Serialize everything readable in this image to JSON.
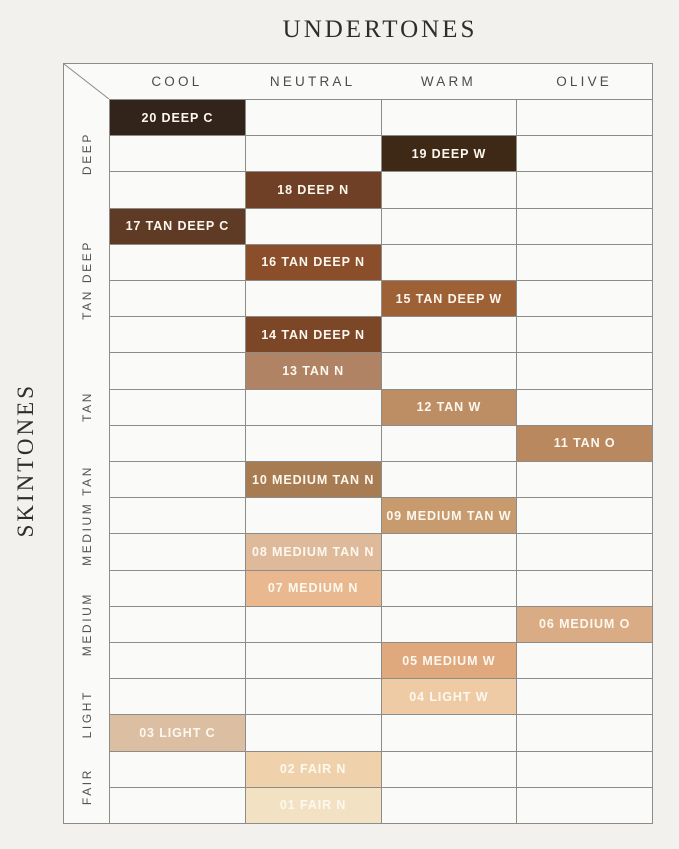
{
  "chart_data": {
    "type": "table",
    "title": "UNDERTONES",
    "ylabel": "SKINTONES",
    "columns": [
      "COOL",
      "NEUTRAL",
      "WARM",
      "OLIVE"
    ],
    "row_groups": [
      {
        "label": "DEEP",
        "rows": 3
      },
      {
        "label": "TAN DEEP",
        "rows": 4
      },
      {
        "label": "TAN",
        "rows": 3
      },
      {
        "label": "MEDIUM TAN",
        "rows": 3
      },
      {
        "label": "MEDIUM",
        "rows": 3
      },
      {
        "label": "LIGHT",
        "rows": 2
      },
      {
        "label": "FAIR",
        "rows": 2
      }
    ],
    "cells": [
      {
        "row": 1,
        "col": 1,
        "label": "20 DEEP C",
        "group": "DEEP",
        "undertone": "COOL",
        "color": "#32241b"
      },
      {
        "row": 2,
        "col": 3,
        "label": "19 DEEP W",
        "group": "DEEP",
        "undertone": "WARM",
        "color": "#3e2917"
      },
      {
        "row": 3,
        "col": 2,
        "label": "18 DEEP N",
        "group": "DEEP",
        "undertone": "NEUTRAL",
        "color": "#6f4026"
      },
      {
        "row": 4,
        "col": 1,
        "label": "17 TAN DEEP C",
        "group": "TAN DEEP",
        "undertone": "COOL",
        "color": "#5f3b25"
      },
      {
        "row": 5,
        "col": 2,
        "label": "16 TAN DEEP N",
        "group": "TAN DEEP",
        "undertone": "NEUTRAL",
        "color": "#8a4e2a"
      },
      {
        "row": 6,
        "col": 3,
        "label": "15 TAN DEEP W",
        "group": "TAN DEEP",
        "undertone": "WARM",
        "color": "#9e6136"
      },
      {
        "row": 7,
        "col": 2,
        "label": "14 TAN DEEP N",
        "group": "TAN DEEP",
        "undertone": "NEUTRAL",
        "color": "#7b4726"
      },
      {
        "row": 8,
        "col": 2,
        "label": "13 TAN N",
        "group": "TAN",
        "undertone": "NEUTRAL",
        "color": "#b18365"
      },
      {
        "row": 9,
        "col": 3,
        "label": "12 TAN W",
        "group": "TAN",
        "undertone": "WARM",
        "color": "#bd8d64"
      },
      {
        "row": 10,
        "col": 4,
        "label": "11 TAN O",
        "group": "TAN",
        "undertone": "OLIVE",
        "color": "#b9885f"
      },
      {
        "row": 11,
        "col": 2,
        "label": "10 MEDIUM TAN N",
        "group": "MEDIUM TAN",
        "undertone": "NEUTRAL",
        "color": "#a87c52"
      },
      {
        "row": 12,
        "col": 3,
        "label": "09 MEDIUM TAN W",
        "group": "MEDIUM TAN",
        "undertone": "WARM",
        "color": "#c79b6e"
      },
      {
        "row": 13,
        "col": 2,
        "label": "08 MEDIUM TAN N",
        "group": "MEDIUM TAN",
        "undertone": "NEUTRAL",
        "color": "#deba9b"
      },
      {
        "row": 14,
        "col": 2,
        "label": "07 MEDIUM N",
        "group": "MEDIUM",
        "undertone": "NEUTRAL",
        "color": "#e9b88e"
      },
      {
        "row": 15,
        "col": 4,
        "label": "06 MEDIUM O",
        "group": "MEDIUM",
        "undertone": "OLIVE",
        "color": "#d9ac86"
      },
      {
        "row": 16,
        "col": 3,
        "label": "05 MEDIUM W",
        "group": "MEDIUM",
        "undertone": "WARM",
        "color": "#dfa87d"
      },
      {
        "row": 17,
        "col": 3,
        "label": "04 LIGHT W",
        "group": "LIGHT",
        "undertone": "WARM",
        "color": "#eecba5"
      },
      {
        "row": 18,
        "col": 1,
        "label": "03 LIGHT C",
        "group": "LIGHT",
        "undertone": "COOL",
        "color": "#dcbfa3"
      },
      {
        "row": 19,
        "col": 2,
        "label": "02 FAIR N",
        "group": "FAIR",
        "undertone": "NEUTRAL",
        "color": "#efd2ab"
      },
      {
        "row": 20,
        "col": 2,
        "label": "01 FAIR N",
        "group": "FAIR",
        "undertone": "NEUTRAL",
        "color": "#f3e1c4"
      }
    ],
    "layout_hints": {
      "line_color": "#8e8c89",
      "page_background": "#f2f1ee",
      "cell_background": "#fafaf9",
      "shade_text_color": "#fdf8ef"
    }
  }
}
